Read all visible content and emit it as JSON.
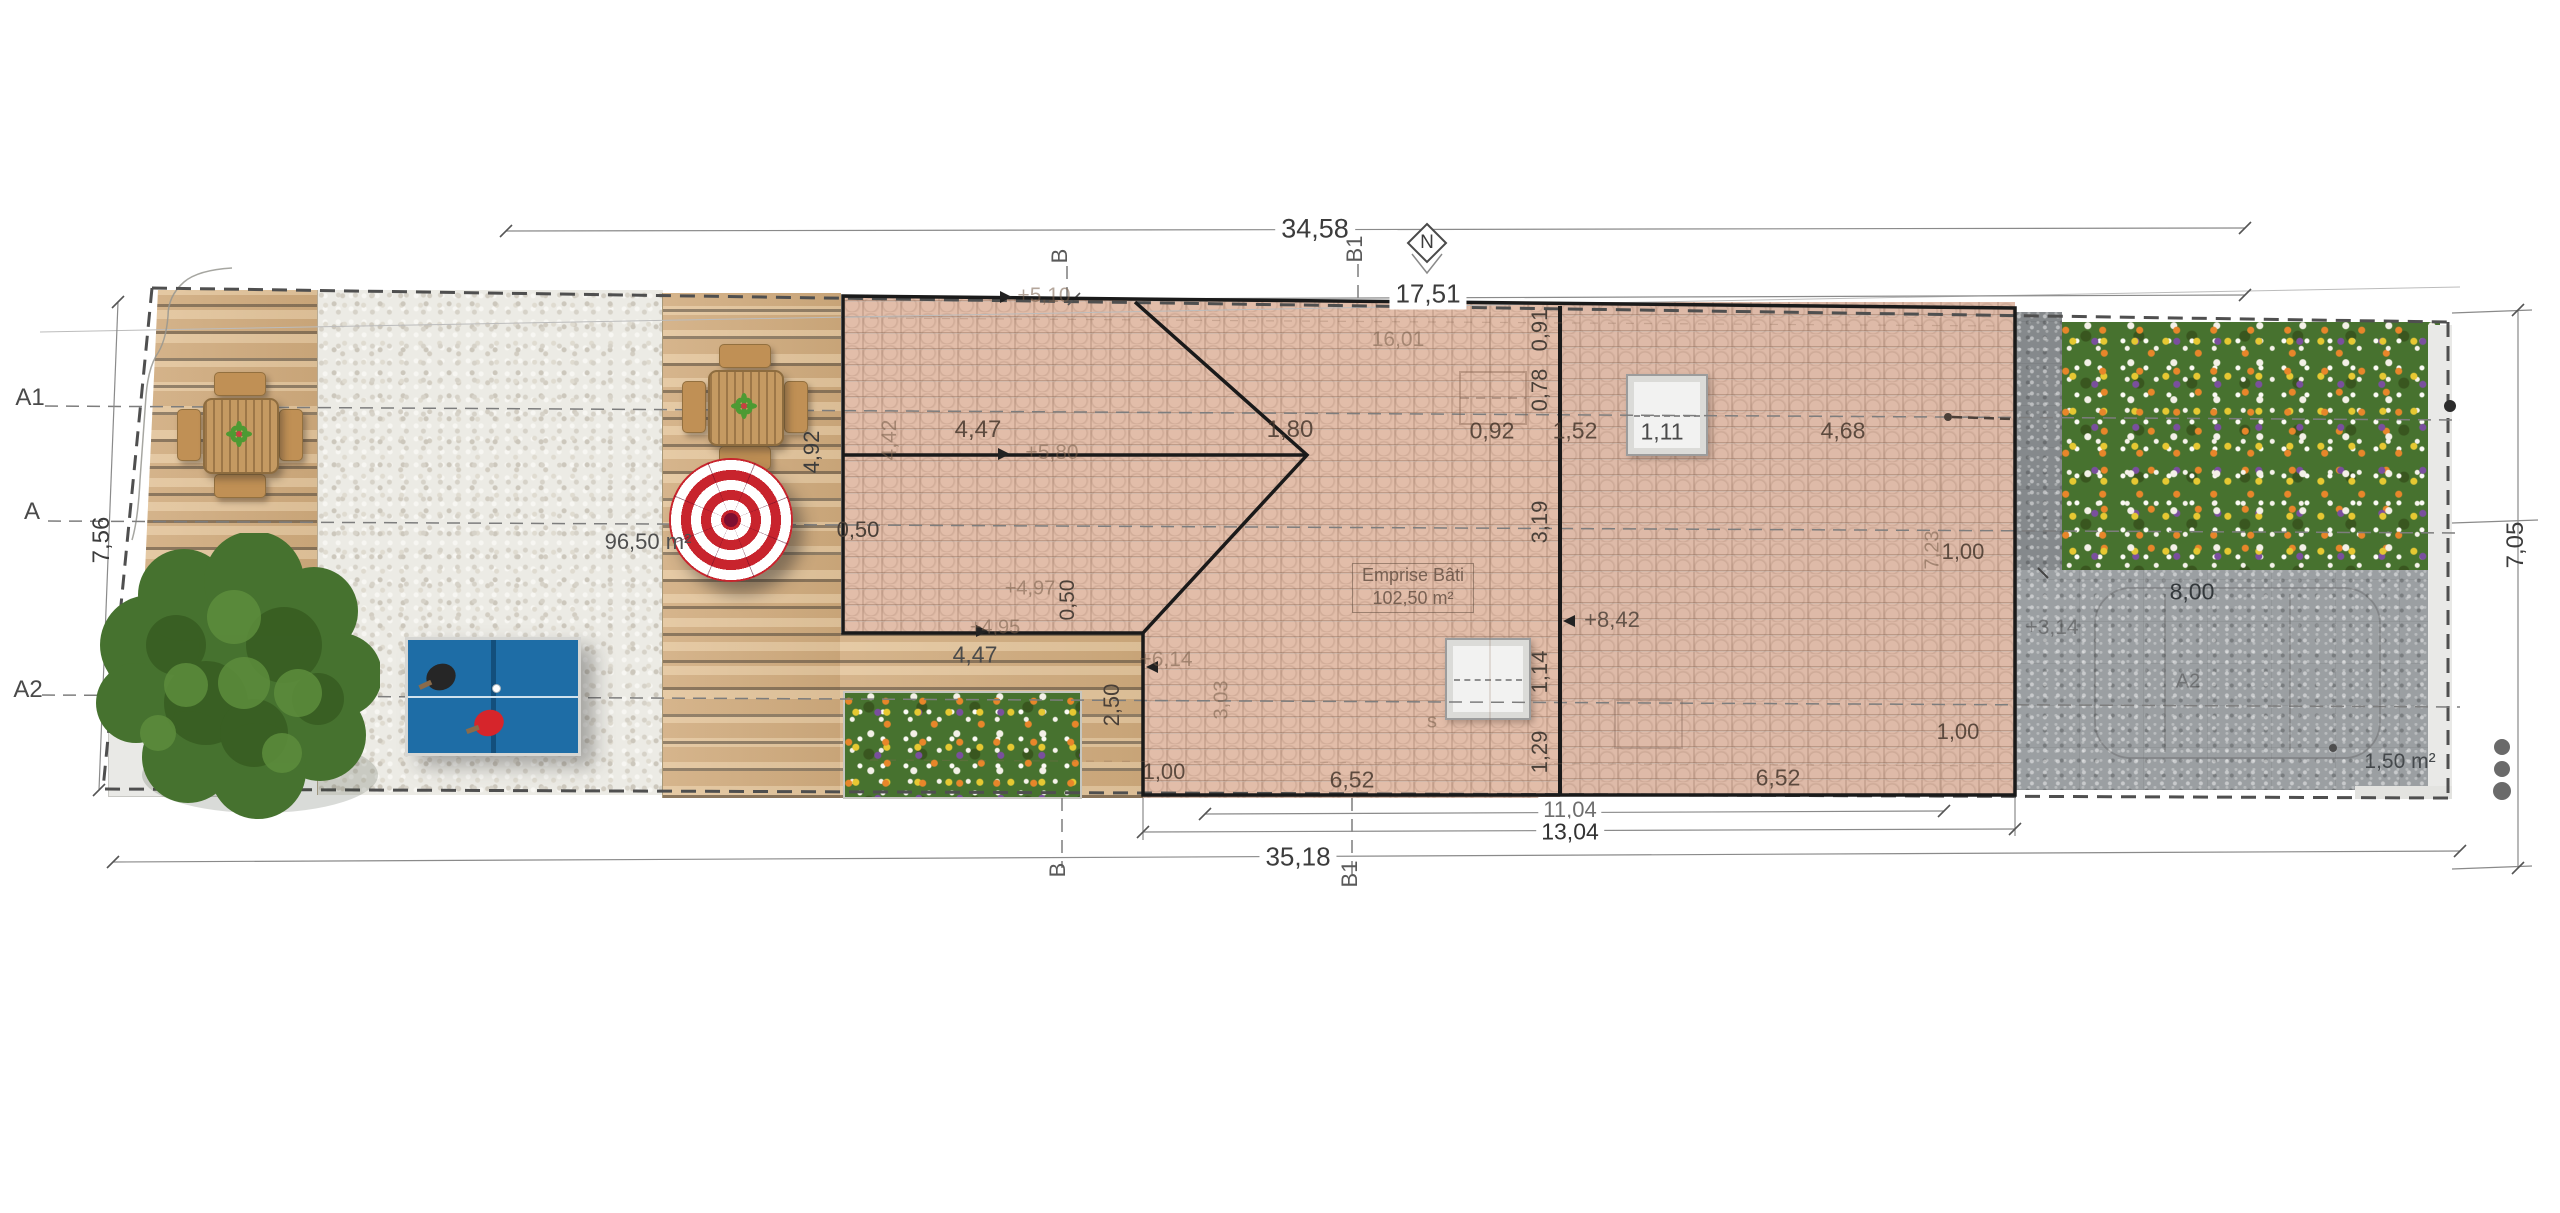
{
  "plan": {
    "north_label": "N",
    "markers": {
      "a1": "A1",
      "a": "A",
      "a2": "A2",
      "b_top": "B",
      "b1_top": "B1",
      "b_bot": "B",
      "b1_bot": "B1",
      "a2_pav": "A2",
      "s": "s"
    },
    "dims": {
      "total_top": "34,58",
      "roof_top": "17,51",
      "left": "7,56",
      "right": "7,05",
      "b_inner": "11,04",
      "b_mid": "13,04",
      "b_total": "35,18",
      "deck_len": "4,92",
      "gap_top": "0,50",
      "roof_seg": "4,47",
      "ridge_left": "4,42",
      "gable": "1,80",
      "dormer": "0,92",
      "dormer_gap": "1,52",
      "sky1_w": "1,11",
      "edge1": "0,91",
      "edge2": "0,78",
      "edge3": "3,19",
      "ridge_total": "16,01",
      "roof_right": "4,68",
      "one_r1": "1,00",
      "one_r2": "1,00",
      "one_l": "1,00",
      "deck_notch": "4,47",
      "notch_h": "2,50",
      "notch_gap": "0,50",
      "notch_side": "3,03",
      "sky2_h": "1,14",
      "edge4": "1,29",
      "right_inner": "7,23",
      "paving_len": "8,00",
      "eave_l": "6,52",
      "eave_r": "6,52"
    },
    "levels": {
      "l510": "+5,10",
      "l580": "+5,80",
      "l497": "+4,97",
      "l495": "+4,95",
      "l614": "+6,14",
      "l842": "+8,42",
      "l314": "+3,14"
    },
    "areas": {
      "terrace": "96,50 m²",
      "emprise_line1": "Emprise Bâti",
      "emprise_line2": "102,50 m²",
      "bed": "1,50 m²"
    },
    "colors": {
      "roof": "#e2bda9",
      "deck": "#d8b488",
      "gravel": "#ecebe5",
      "paving": "#9b9fa2",
      "meadow_green": "#47722f",
      "parasol_red": "#c8242d",
      "pingpong_blue": "#1e6da6",
      "line_bold": "#1a1a1a"
    }
  }
}
